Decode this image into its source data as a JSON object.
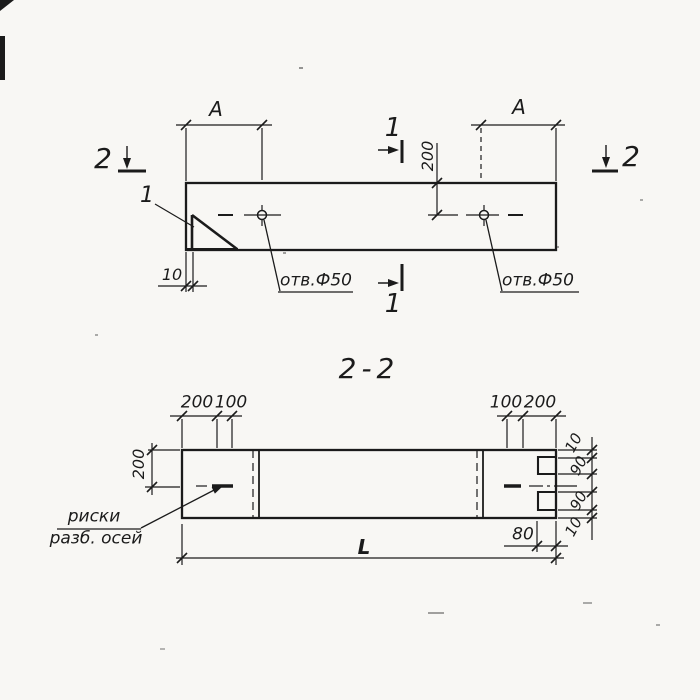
{
  "meta": {
    "ink_color": "#1b1b1b",
    "paper_color": "#f8f7f4"
  },
  "plan": {
    "span_left": "A",
    "span_right": "A",
    "hole_axis_offset": "200",
    "edge_offset": "10",
    "hole_left_label": "отв.Ф50",
    "hole_right_label": "отв.Ф50",
    "detail_mark": "1",
    "cut_2_left": "2",
    "cut_2_right": "2",
    "cut_1_top": "1",
    "cut_1_bottom": "1"
  },
  "section": {
    "title": "2-2",
    "top_left_200": "200",
    "top_left_100": "100",
    "top_right_100": "100",
    "top_right_200": "200",
    "height_to_axis": "200",
    "chain_10_top": "10",
    "chain_90_top": "90",
    "chain_90_bottom": "90",
    "chain_10_bottom": "10",
    "notch_offset": "80",
    "overall_length": "L",
    "axis_note_line1": "риски",
    "axis_note_line2": "разб. осей"
  }
}
